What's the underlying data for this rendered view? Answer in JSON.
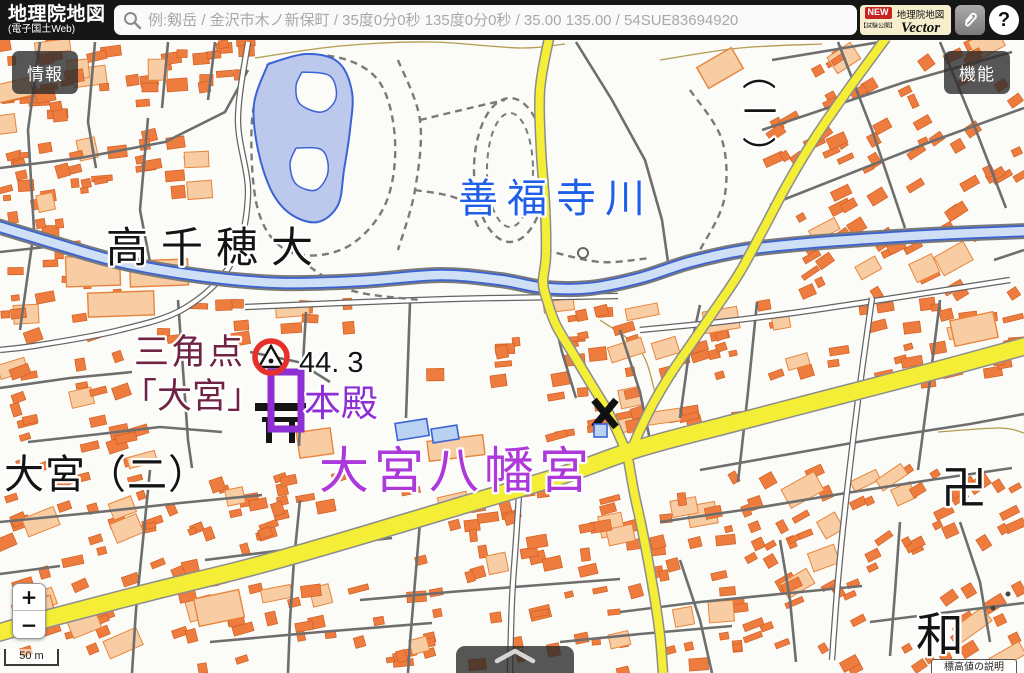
{
  "header": {
    "logo_title": "地理院地図",
    "logo_subtitle": "(電子国土Web)",
    "search_placeholder": "例:剱岳 / 金沢市木ノ新保町 / 35度0分0秒 135度0分0秒 / 35.00 135.00 / 54SUE83694920",
    "vector_badge": {
      "new_label": "NEW",
      "product": "地理院地図",
      "trial_note": "【試験公開】",
      "name": "Vector"
    },
    "help_label": "?"
  },
  "controls": {
    "info_button": "情報",
    "function_button": "機能",
    "zoom_in": "+",
    "zoom_out": "−",
    "scale_label": "50 m",
    "elevation_note": "標高値の説明"
  },
  "map": {
    "labels": [
      {
        "id": "takachiho-univ",
        "text": "高千穂大",
        "color": "#141414"
      },
      {
        "id": "zenpukuji-river",
        "text": "善福寺川",
        "color": "#1f5fe8"
      },
      {
        "id": "triangulation-line1",
        "text": "三角点",
        "color": "#702343"
      },
      {
        "id": "triangulation-line2",
        "text": "「大宮」",
        "color": "#702343"
      },
      {
        "id": "spot-elevation",
        "text": "44. 3",
        "color": "#141414"
      },
      {
        "id": "honden",
        "text": "本殿",
        "color": "#8d2fd2"
      },
      {
        "id": "omiya-hachimangu",
        "text": "大宮八幡宮",
        "color": "#ad39da"
      },
      {
        "id": "omiya-2chome",
        "text": "大宮（二）",
        "color": "#141414"
      },
      {
        "id": "wada",
        "text": "和",
        "color": "#141414"
      },
      {
        "id": "temple-manji",
        "text": "卍",
        "color": "#141414"
      }
    ],
    "chome_vertical": {
      "open": "（",
      "num": "一",
      "close": "）"
    },
    "symbols": [
      "triangulation-point",
      "police-box-x",
      "shrine-torii",
      "temple-manji",
      "search-result-ring"
    ],
    "palette": {
      "building": "#ef7c3f",
      "building_outline": "#d05f22",
      "building_large": "#f8cda4",
      "building_large_outline": "#e8853c",
      "road_major_yellow": "#f4ee36",
      "road_casing": "#8d8d8d",
      "road_minor": "#6e6e6e",
      "water_fill": "#cfe0f6",
      "water_line": "#3c63d4",
      "pond_fill": "#bcc9ec",
      "contour": "#b49b4e",
      "marker_red": "#e8302a",
      "symbol_black": "#111111"
    }
  }
}
